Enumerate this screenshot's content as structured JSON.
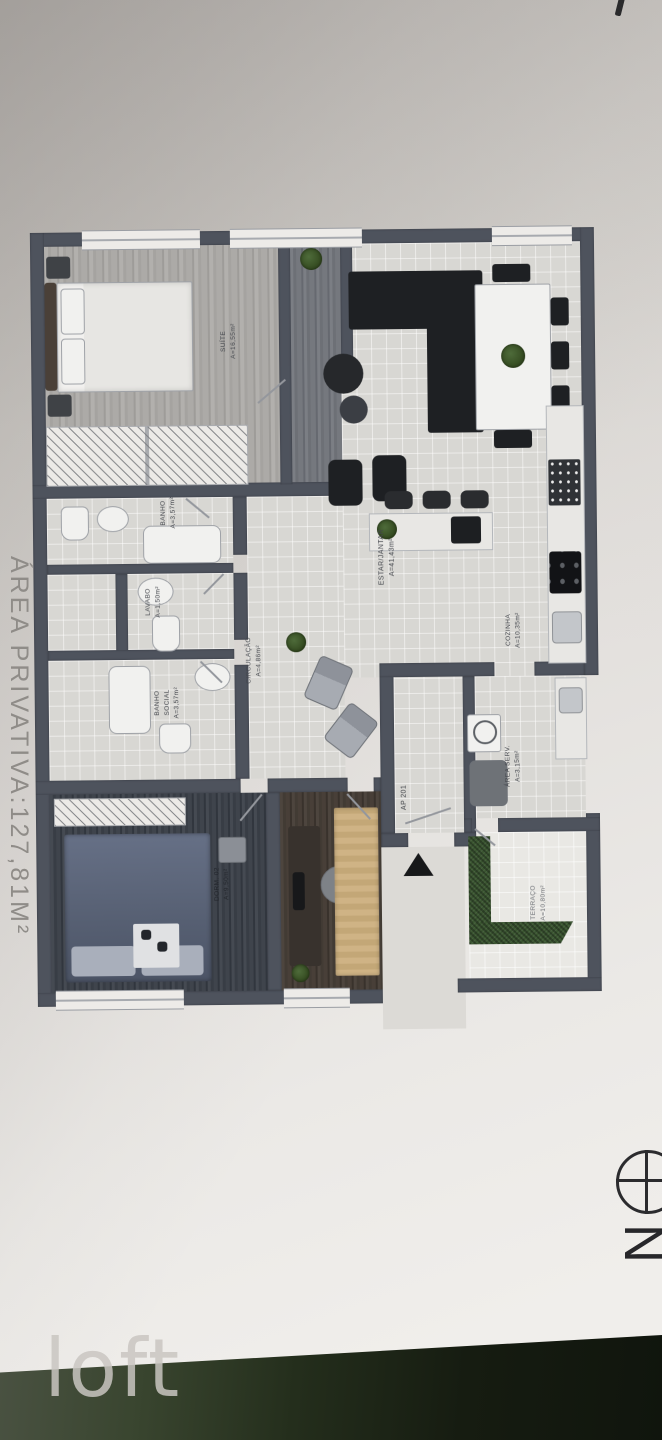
{
  "photo": {
    "side_text": "ÁREA PRIVATIVA:127,81M²",
    "watermark": "loft",
    "compass_letter": "N"
  },
  "plan": {
    "unit_tag": "AP 201",
    "rooms": {
      "suite": {
        "name": "SUÍTE",
        "area": "A=16,55m²"
      },
      "banho": {
        "name": "BANHO",
        "area": "A=3,57m²"
      },
      "lavabo": {
        "name": "LAVABO",
        "area": "A=1,50m²"
      },
      "banho_social": {
        "name": "BANHO",
        "name2": "SOCIAL",
        "area": "A=3,57m²"
      },
      "circulacao": {
        "name": "CIRCULAÇÃO",
        "area": "A=4,86m²"
      },
      "estar": {
        "name": "ESTAR/JANTAR",
        "area": "A=41,43m²"
      },
      "cozinha": {
        "name": "COZINHA",
        "area": "A=10,35m²"
      },
      "area_serv": {
        "name": "ÁREA SERV.",
        "area": "A=3,15m²"
      },
      "terraco": {
        "name": "TERRAÇO",
        "area": "A=10,80m²"
      },
      "dorm02": {
        "name": "DORM. 02",
        "area": "A=9,50m²"
      }
    }
  },
  "colors": {
    "wall": "#4e535d",
    "paper": "#e3e0dd",
    "table_green": "#242e1c",
    "hedge_green": "#3a5530",
    "sofa_black": "#1e2023"
  }
}
